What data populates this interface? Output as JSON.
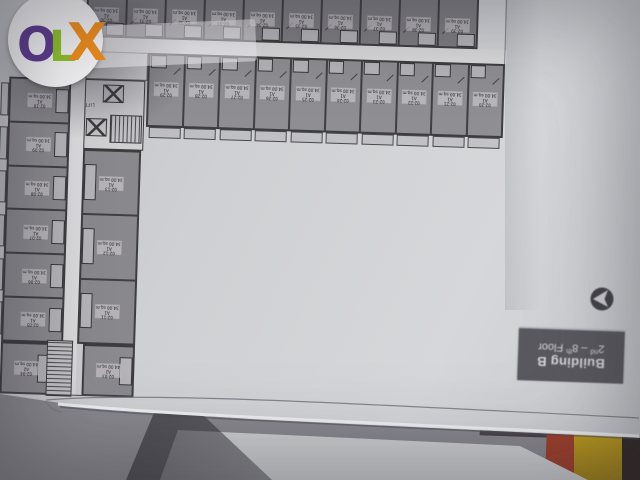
{
  "logo": {
    "letters": [
      {
        "char": "O",
        "color": "#5d3b8e"
      },
      {
        "char": "L",
        "color": "#8dc02c"
      },
      {
        "char": "X",
        "color": "#ee8d1d"
      }
    ]
  },
  "building_label": {
    "line1": "Building B",
    "line2_parts": {
      "p1": "2",
      "sup1": "nd",
      "p2": " – 8",
      "sup2": "th",
      "p3": " Floor"
    }
  },
  "plan": {
    "lift_label": "LIFT",
    "top_row": {
      "units": [
        {
          "id": "02-30",
          "type": "A1",
          "area": "34.00 sq.m"
        },
        {
          "id": "02-31",
          "type": "A1",
          "area": "34.00 sq.m"
        },
        {
          "id": "02-32",
          "type": "A1",
          "area": "34.00 sq.m"
        },
        {
          "id": "02-33",
          "type": "A1",
          "area": "34.00 sq.m"
        },
        {
          "id": "02-34",
          "type": "A1",
          "area": "34.00 sq.m"
        },
        {
          "id": "02-35",
          "type": "A1",
          "area": "34.00 sq.m"
        },
        {
          "id": "02-36",
          "type": "A1",
          "area": "34.00 sq.m"
        },
        {
          "id": "02-37",
          "type": "A1",
          "area": "34.00 sq.m"
        },
        {
          "id": "02-38",
          "type": "A1",
          "area": "34.00 sq.m"
        },
        {
          "id": "02-39",
          "type": "A1",
          "area": "34.00 sq.m"
        }
      ]
    },
    "second_row": {
      "units": [
        {
          "id": "02-29",
          "type": "A1",
          "area": "34.00 sq.m"
        },
        {
          "id": "02-28",
          "type": "A1",
          "area": "34.00 sq.m"
        },
        {
          "id": "02-27",
          "type": "A1",
          "area": "34.00 sq.m"
        },
        {
          "id": "02-26",
          "type": "A1",
          "area": "34.00 sq.m"
        },
        {
          "id": "02-25",
          "type": "A1",
          "area": "34.00 sq.m"
        },
        {
          "id": "02-24",
          "type": "A1",
          "area": "34.00 sq.m"
        },
        {
          "id": "02-23",
          "type": "A1",
          "area": "34.00 sq.m"
        },
        {
          "id": "02-22",
          "type": "A1",
          "area": "34.00 sq.m"
        },
        {
          "id": "02-21",
          "type": "A1",
          "area": "34.00 sq.m"
        },
        {
          "id": "02-20",
          "type": "A1",
          "area": "34.00 sq.m"
        }
      ]
    },
    "left_outer": {
      "units": [
        {
          "id": "02-10",
          "type": "A1",
          "area": "34.00 sq.m"
        },
        {
          "id": "02-09",
          "type": "A1",
          "area": "34.00 sq.m"
        },
        {
          "id": "02-08",
          "type": "A1",
          "area": "34.00 sq.m"
        },
        {
          "id": "02-07",
          "type": "A1",
          "area": "34.00 sq.m"
        },
        {
          "id": "02-06",
          "type": "A1",
          "area": "34.00 sq.m"
        },
        {
          "id": "02-05",
          "type": "A1",
          "area": "34.00 sq.m"
        }
      ]
    },
    "left_inner": {
      "units": [
        {
          "id": "02-13",
          "type": "A1",
          "area": "34.00 sq.m"
        },
        {
          "id": "02-12",
          "type": "A1",
          "area": "34.00 sq.m"
        },
        {
          "id": "02-11",
          "type": "A1",
          "area": "34.00 sq.m"
        }
      ]
    },
    "bottom_row": {
      "units": [
        {
          "id": "02-04",
          "type": "A2",
          "area": "44.00 sq.m"
        },
        {
          "id": "02-03",
          "type": "A2",
          "area": "44.00 sq.m"
        }
      ]
    }
  },
  "colors": {
    "paper": "#cfd0d3",
    "room_fill": "#8d8c90",
    "room_fill_dark": "#7e7d81",
    "wall": "#413f43",
    "corridor": "#dadadc",
    "floor_label_bg": "#5a595f",
    "floor_label_text": "#d8d7dc",
    "book_yellow": "#c6a41f",
    "book_red": "#9d3f2c"
  }
}
